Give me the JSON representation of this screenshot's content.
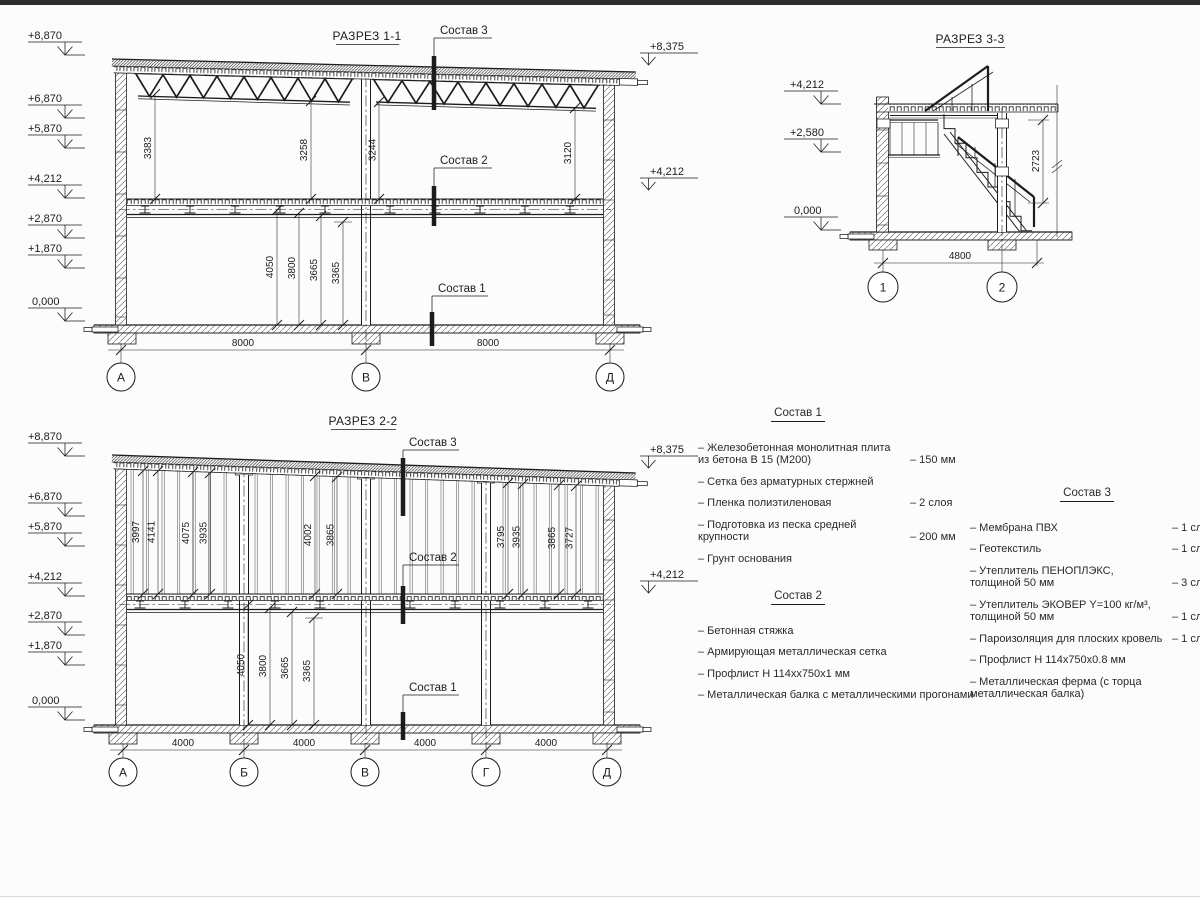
{
  "s11": {
    "title": "РАЗРЕЗ 1-1",
    "elev": [
      "+8,870",
      "+6,870",
      "+5,870",
      "+4,212",
      "+2,870",
      "+1,870",
      "0,000"
    ],
    "elev_r": [
      "+8,375",
      "+4,212"
    ],
    "dims_upper": [
      "3383",
      "3258",
      "3244",
      "3120"
    ],
    "dims_lower": [
      "4050",
      "3800",
      "3665",
      "3365"
    ],
    "dims_bottom": [
      "8000",
      "8000"
    ],
    "axes": [
      "А",
      "В",
      "Д"
    ],
    "callouts": [
      "Состав 3",
      "Состав 2",
      "Состав 1"
    ]
  },
  "s22": {
    "title": "РАЗРЕЗ 2-2",
    "elev": [
      "+8,870",
      "+6,870",
      "+5,870",
      "+4,212",
      "+2,870",
      "+1,870",
      "0,000"
    ],
    "elev_r": [
      "+8,375",
      "+4,212"
    ],
    "dims_upper": [
      "3997",
      "4141",
      "4075",
      "3935",
      "4002",
      "3865",
      "3795",
      "3935",
      "3865",
      "3727"
    ],
    "dims_lower": [
      "4050",
      "3800",
      "3665",
      "3365"
    ],
    "dims_bottom": [
      "4000",
      "4000",
      "4000",
      "4000"
    ],
    "axes": [
      "А",
      "Б",
      "В",
      "Г",
      "Д"
    ],
    "callouts": [
      "Состав 3",
      "Состав 2",
      "Состав 1"
    ]
  },
  "s33": {
    "title": "РАЗРЕЗ 3-3",
    "elev": [
      "+4,212",
      "+2,580",
      "0,000"
    ],
    "dim_v": "2723",
    "dim_b": "4800",
    "axes": [
      "1",
      "2"
    ]
  },
  "lists": {
    "l1": {
      "title": "Состав 1",
      "items": [
        {
          "n": "– Железобетонная  монолитная плита из бетона В 15 (М200)",
          "v": "– 150 мм"
        },
        {
          "n": "– Сетка без арматурных стержней",
          "v": ""
        },
        {
          "n": "– Пленка полиэтиленовая",
          "v": "– 2 слоя"
        },
        {
          "n": "– Подготовка из песка средней крупности",
          "v": "– 200 мм"
        },
        {
          "n": "– Грунт основания",
          "v": ""
        }
      ]
    },
    "l2": {
      "title": "Состав 2",
      "items": [
        {
          "n": "– Бетонная стяжка",
          "v": ""
        },
        {
          "n": "– Армирующая металлическая сетка",
          "v": ""
        },
        {
          "n": "– Профлист Н 114хх750х1 мм",
          "v": ""
        },
        {
          "n": "– Металлическая балка с металлическими прогонами",
          "v": ""
        }
      ]
    },
    "l3": {
      "title": "Состав 3",
      "items": [
        {
          "n": "– Мембрана ПВХ",
          "v": "– 1 слой"
        },
        {
          "n": "– Геотекстиль",
          "v": "– 1 слой"
        },
        {
          "n": "– Утеплитель ПЕНОПЛЭКС, толщиной 50 мм",
          "v": "– 3 слоя"
        },
        {
          "n": "– Утеплитель ЭКОВЕР Y=100 кг/м³, толщиной 50 мм",
          "v": "– 1 слой"
        },
        {
          "n": "– Пароизоляция для плоских кровель",
          "v": "– 1 слой"
        },
        {
          "n": "– Профлист Н 114х750х0.8 мм",
          "v": ""
        },
        {
          "n": "– Металлическая ферма (с торца металлическая балка)",
          "v": ""
        }
      ]
    }
  }
}
